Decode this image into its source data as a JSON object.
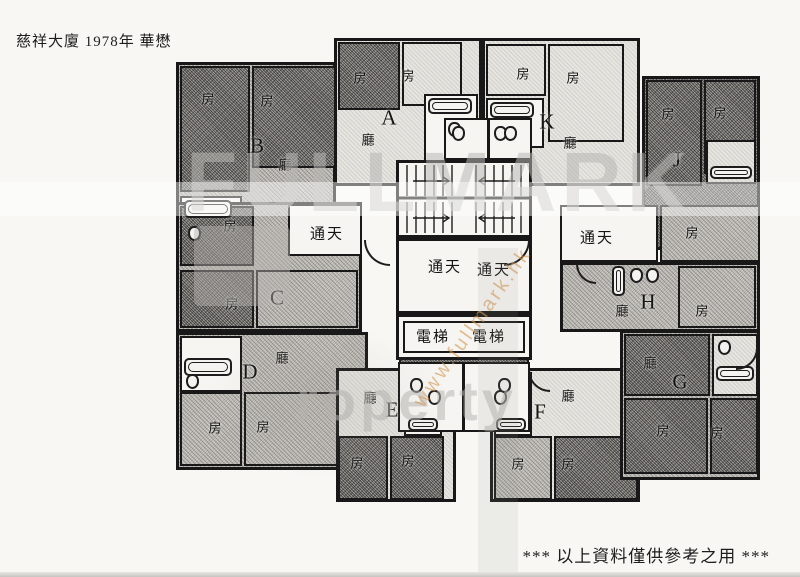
{
  "document": {
    "title": "慈祥大廈 1978年 華懋",
    "footer_note": "*** 以上資料僅供參考之用 ***"
  },
  "watermark": {
    "brand_top": "FULLMARK",
    "brand_bottom": "roperty",
    "url_diagonal": "www.fullmark.hk"
  },
  "colors": {
    "ink": "#181818",
    "paper": "#f8f7f4",
    "watermark_gray": "#b8b6b2",
    "watermark_orange": "#d69650"
  },
  "plan": {
    "unit_labels": {
      "a": "A",
      "b": "B",
      "c": "C",
      "d": "D",
      "e": "E",
      "f": "F",
      "g": "G",
      "h": "H",
      "j": "J",
      "k": "K"
    },
    "room_labels": {
      "bedroom": "房",
      "living_room": "廳",
      "lightwell": "通天",
      "lift": "電梯"
    }
  }
}
